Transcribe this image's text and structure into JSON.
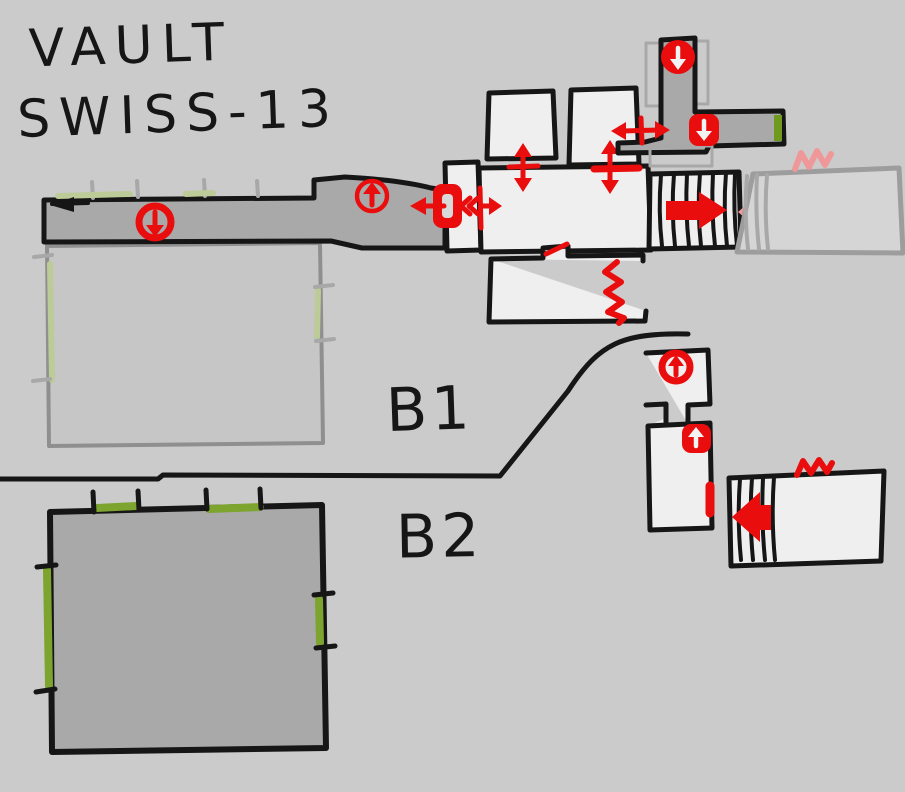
{
  "title": {
    "line1": "VAULT",
    "line2": "SWISS-13"
  },
  "levels": {
    "b1_label": "B1",
    "b2_label": "B2"
  },
  "colors": {
    "background": "#cccbcb",
    "ink": "#161616",
    "corridor_gray": "#a9a9a9",
    "room_white": "#f0efef",
    "b1_room_gray": "#c6c6c6",
    "b1_room_outline": "#8f8f8f",
    "side_room_gray": "#d5d5d5",
    "side_room_outline": "#9d9d9d",
    "ghost_gray": "#a8a8a8",
    "accent_red": "#ea0d0d",
    "pink": "#ef989a",
    "olive_green": "#7da42e",
    "pale_green": "#bccb97",
    "bright_green": "#6f9a1f"
  },
  "symbols": {
    "stairs_down_icon": "red circled down arrow",
    "stairs_up_icon": "red circled up arrow",
    "door_icon": "red door block with two-way arrow",
    "passage_arrow_icon": "red double-headed arrow through wall",
    "one_way_arrow_icon": "solid red thick arrow",
    "blocked_arrow_icon": "solid pink thick arrow",
    "hazard_zigzag_icon": "red zigzag line",
    "breach_marker_icon": "red bar on wall",
    "wall_highlight_marker": "green wall highlight"
  }
}
